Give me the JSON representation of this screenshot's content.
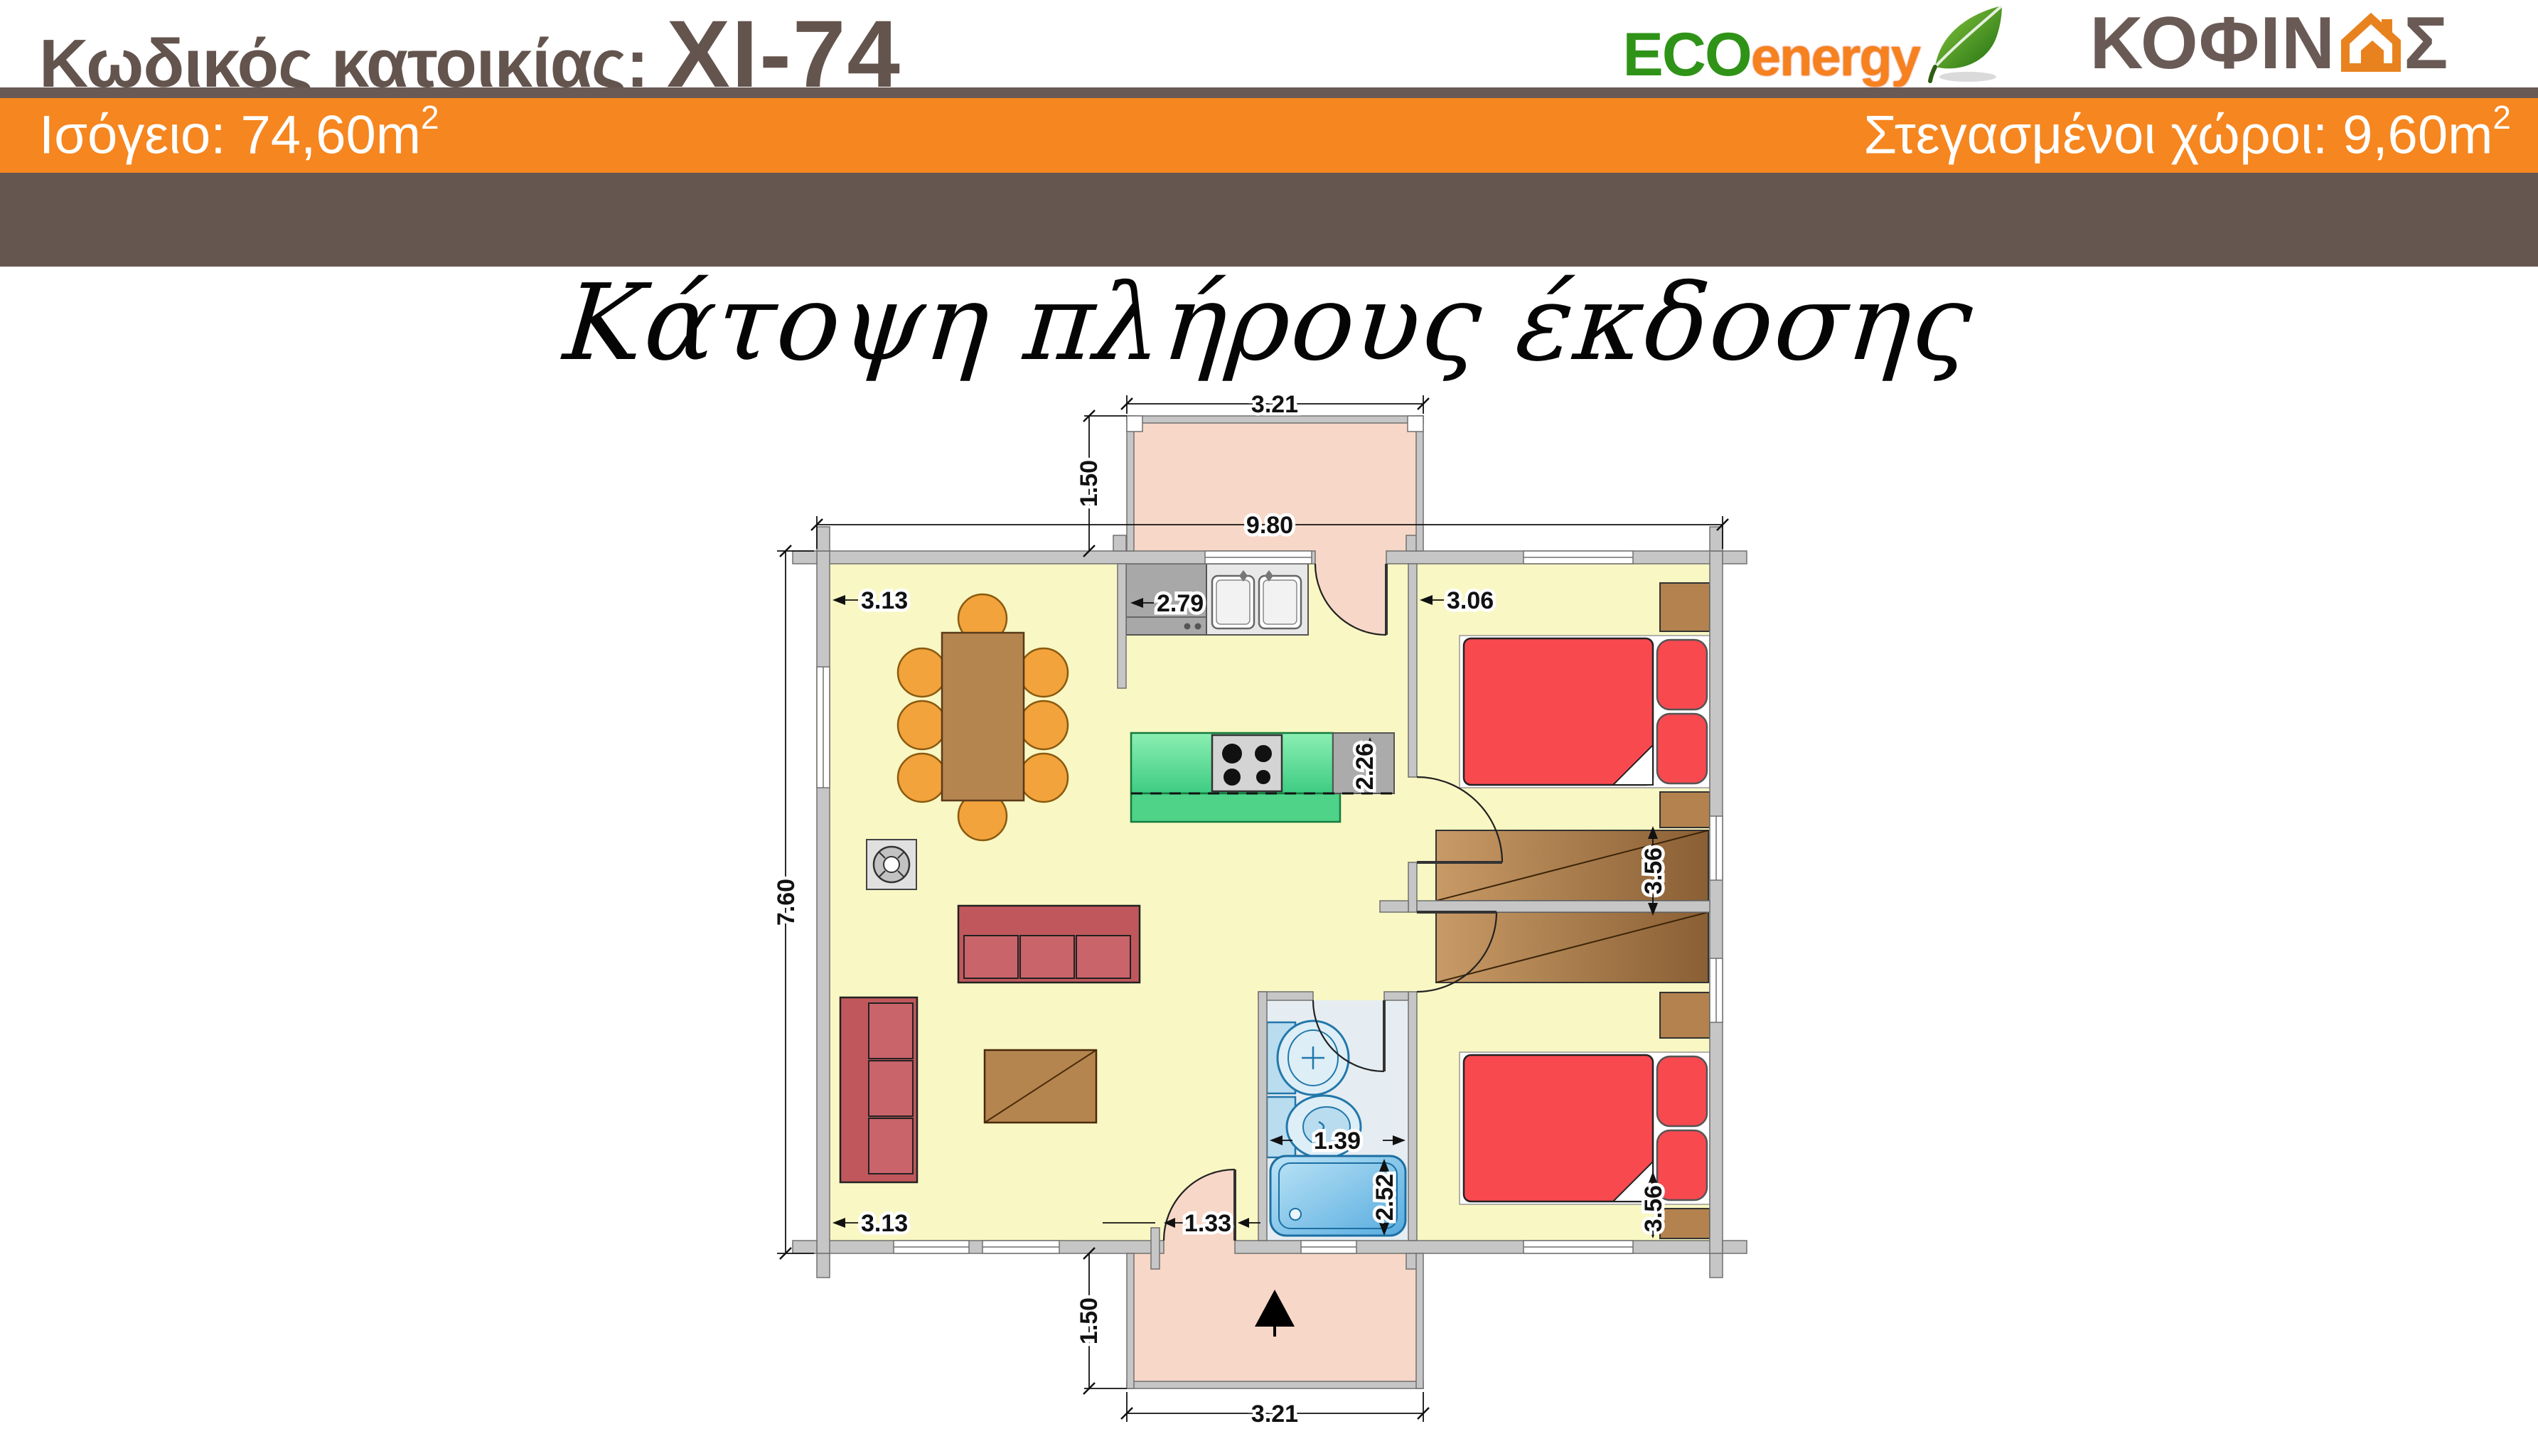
{
  "header": {
    "code_label": "Κωδικός κατοικίας:",
    "code_value": "XI-74",
    "logo": {
      "eco": "ECO",
      "energy": "energy",
      "brand_prefix": "ΚΟΦΙΝ",
      "brand_suffix": "Σ",
      "tagline": "ΞΥΛΙΝΑ ΦΙΝΛΑΝΔΙΚΑ ΣΠΙΤΙΑ"
    }
  },
  "info_bar": {
    "left_text": "Ισόγειο: 74,60m",
    "left_sup": "2",
    "right_text": "Στεγασμένοι χώροι: 9,60m",
    "right_sup": "2"
  },
  "drawing": {
    "title": "Κάτοψη πλήρους έκδοσης",
    "dimensions": {
      "porch_top_width": "3.21",
      "porch_top_depth": "1.50",
      "house_width": "9.80",
      "house_depth": "7.60",
      "living_top": "3.13",
      "living_bottom": "3.13",
      "kitchen_wall": "2.79",
      "island_length": "2.26",
      "bedroom1_width": "3.06",
      "bedroom1_depth": "3.56",
      "bedroom2_depth": "3.56",
      "bath_width": "1.39",
      "bath_depth": "2.52",
      "entry_width": "1.33",
      "porch_bottom_depth": "1.50",
      "porch_bottom_width": "3.21"
    },
    "colors": {
      "floor": "#F9F7C3",
      "porch": "#F7D7C7",
      "bath_floor": "#E5EDF2",
      "wall": "#C6C6C6",
      "bed": "#F8494F",
      "counter_green": "#5FDD96",
      "wood": "#B5854F",
      "chair": "#F2A33C",
      "sofa": "#C0575C",
      "tub": "#85C6EA",
      "accent_orange": "#F6861F",
      "band_brown": "#665650",
      "text_brown": "#64544E"
    }
  }
}
